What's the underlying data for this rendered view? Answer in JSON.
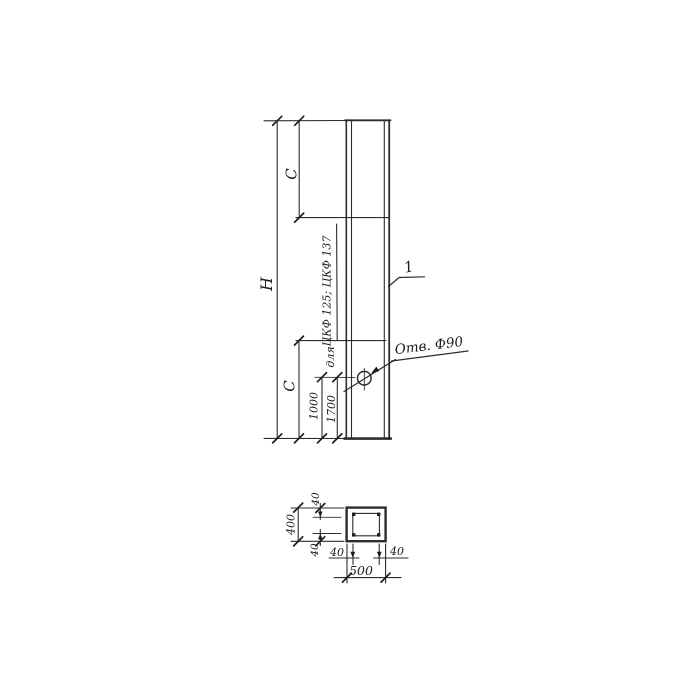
{
  "colors": {
    "ink": "#222222",
    "paper": "#ffffff"
  },
  "elevation": {
    "labels": {
      "overall_height": "H",
      "top_offset": "C",
      "bottom_offset": "C",
      "hole_dim_a": "1000",
      "hole_dim_b": "1700",
      "note_prefix": "для",
      "note_series": "ЦКФ 125; ЦКФ 137",
      "hole_callout": "Отв. Ф90",
      "item_mark": "1"
    }
  },
  "section": {
    "labels": {
      "overall_width": "500",
      "overall_height": "400",
      "cover_top": "40",
      "cover_bottom": "40",
      "cover_left": "40",
      "cover_right": "40"
    }
  }
}
